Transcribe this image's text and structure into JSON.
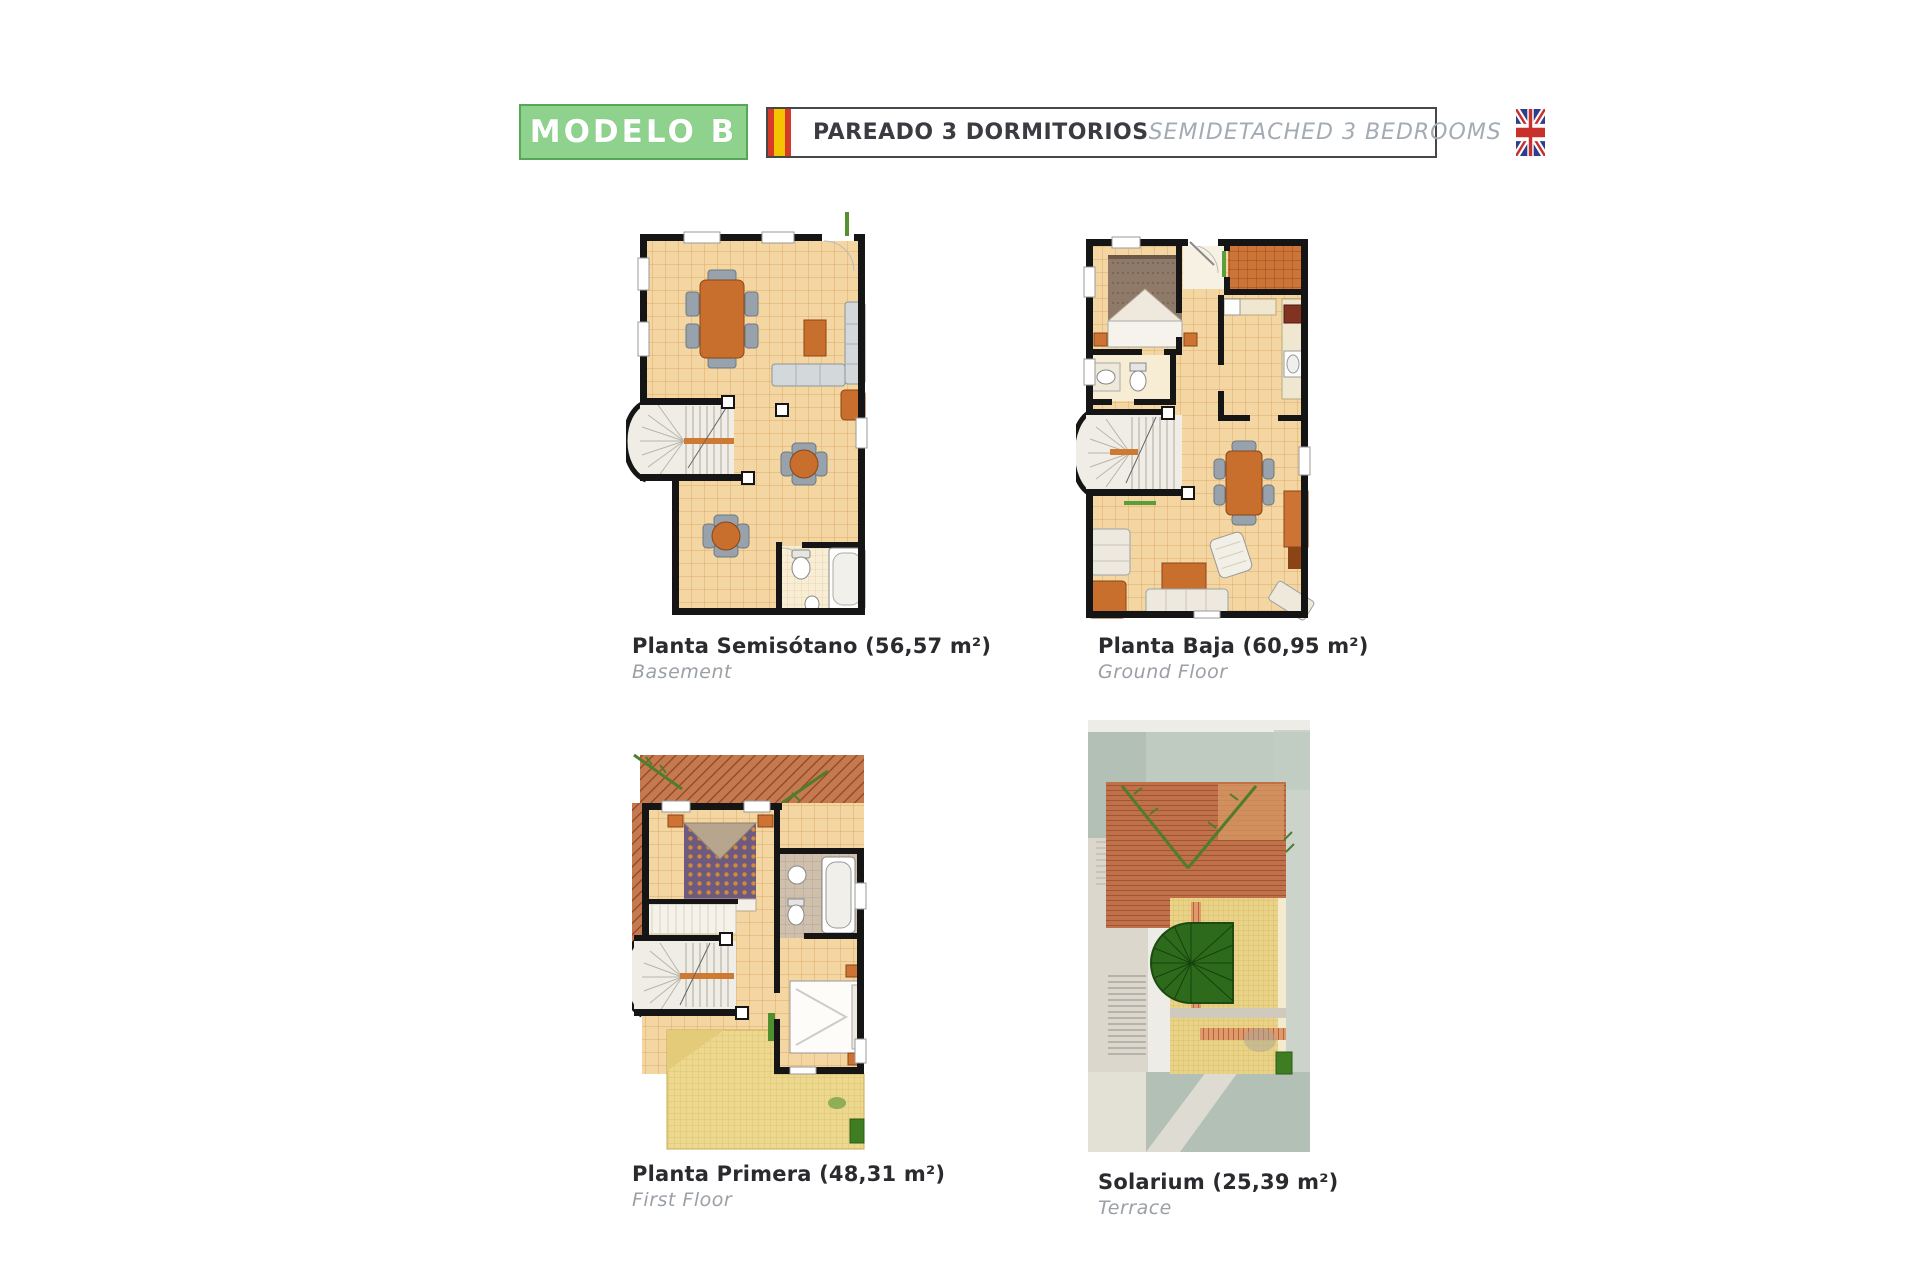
{
  "header": {
    "model_label": "MODELO B",
    "title_es": "PAREADO 3 DORMITORIOS",
    "title_en": "SEMIDETACHED 3 BEDROOMS",
    "colors": {
      "badge_fill": "#8ed28e",
      "badge_border": "#57a757",
      "bar_border": "#474747",
      "spain_flag_red": "#d83a2a",
      "spain_flag_yellow": "#f5c400",
      "uk_flag_blue": "#2b3f8e",
      "uk_flag_red": "#c8312b"
    },
    "icons": {
      "left_flag": "spain-flag-icon",
      "right_flag": "uk-flag-icon"
    }
  },
  "plans": [
    {
      "id": "basement",
      "title": "Planta Semisótano (56,57 m²)",
      "subtitle": "Basement"
    },
    {
      "id": "ground-floor",
      "title": "Planta Baja (60,95 m²)",
      "subtitle": "Ground Floor"
    },
    {
      "id": "first-floor",
      "title": "Planta Primera (48,31 m²)",
      "subtitle": "First Floor"
    },
    {
      "id": "solarium",
      "title": "Solarium (25,39 m²)",
      "subtitle": "Terrace"
    }
  ]
}
